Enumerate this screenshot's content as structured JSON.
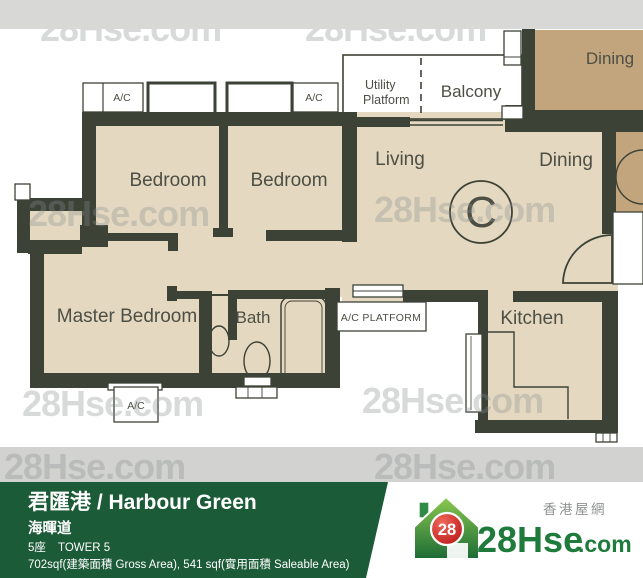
{
  "plan": {
    "labels": {
      "bedroom1": "Bedroom",
      "bedroom2": "Bedroom",
      "master_bedroom": "Master Bedroom",
      "bath": "Bath",
      "living": "Living",
      "dining": "Dining",
      "kitchen": "Kitchen",
      "balcony": "Balcony",
      "utility_line1": "Utility",
      "utility_line2": "Platform",
      "neighbor_dining": "Dining",
      "flat_letter": "C",
      "ac": "A/C",
      "ac_platform": "A/C PLATFORM"
    },
    "colors": {
      "wall": "#3d4237",
      "floor": "#e5d8c1",
      "neighbor_floor": "#c2a57d",
      "label": "#4d4f45"
    }
  },
  "watermark": {
    "text": "28Hse.com"
  },
  "banner": {
    "title": "君匯港 / Harbour Green",
    "street": "海暉道",
    "tower_cn": "5座",
    "tower_en": "TOWER 5",
    "area_info": "702sqf(建築面積 Gross Area), 541 sqf(實用面積 Saleable Area)",
    "bg_color": "#1c5b38"
  },
  "logo": {
    "tagline_cn": "香港屋網",
    "badge": "28",
    "brand": "28Hse",
    "suffix": ".com",
    "green": "#1f7b3c",
    "red": "#c41414"
  }
}
